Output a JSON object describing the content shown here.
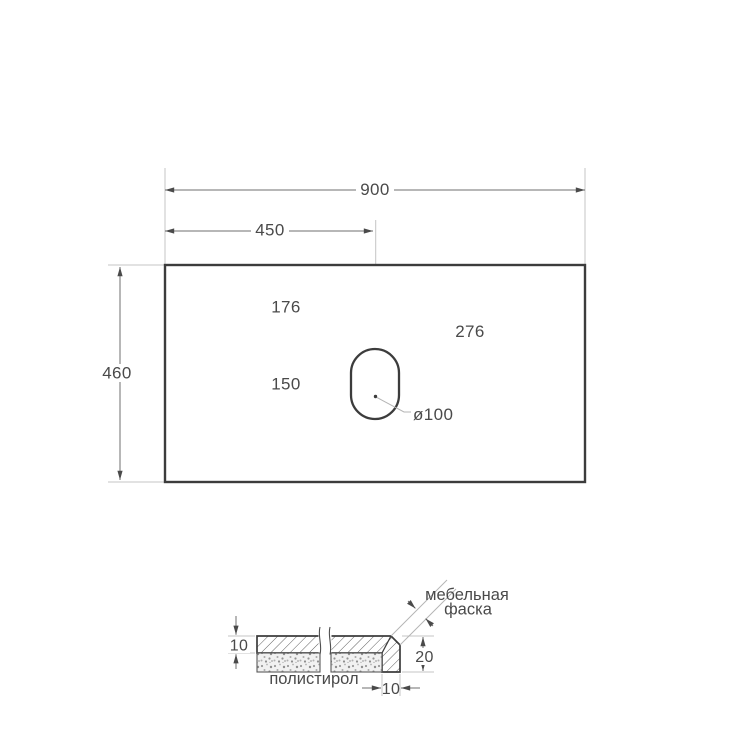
{
  "plan_view": {
    "overall_width": "900",
    "hole_center_from_left": "450",
    "overall_depth": "460",
    "hole_top_offset": "176",
    "hole_slot_length": "150",
    "hole_center_from_top": "276",
    "hole_diameter": "ø100"
  },
  "section_view": {
    "top_thickness": "10",
    "front_edge_height": "20",
    "front_edge_width": "10",
    "core_material_label": "полистирол",
    "chamfer_label_line1": "мебельная",
    "chamfer_label_line2": "фаска"
  },
  "colors": {
    "outline": "#3c3c3c",
    "dimension_line": "#6f6f6f",
    "extension_line": "#c4c4c4",
    "text": "#4a4a4a",
    "background": "#ffffff"
  }
}
